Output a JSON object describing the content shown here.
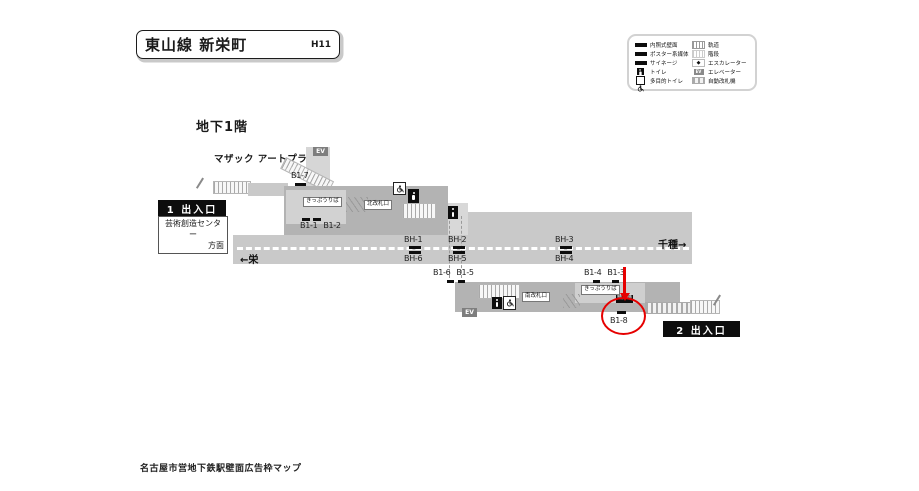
{
  "title": {
    "station_line": "東山線 新栄町",
    "station_code": "H11"
  },
  "floor_label": "地下1階",
  "note_mazak": "マザック アートプラザへ",
  "caption": "名古屋市営地下鉄駅壁面広告枠マップ",
  "legend": {
    "left": [
      {
        "icon": "lit-wall-sign",
        "label": "内照式壁面"
      },
      {
        "icon": "poster-media",
        "label": "ポスター系媒体"
      },
      {
        "icon": "signage",
        "label": "サイネージ"
      },
      {
        "icon": "toilet",
        "label": "トイレ"
      },
      {
        "icon": "accessible-toilet",
        "label": "多目的トイレ"
      }
    ],
    "right": [
      {
        "icon": "track",
        "label": "軌道"
      },
      {
        "icon": "stairs",
        "label": "階段"
      },
      {
        "icon": "escalator",
        "label": "エスカレーター"
      },
      {
        "icon": "elevator",
        "label": "エレベーター"
      },
      {
        "icon": "ticket-gate",
        "label": "自動改札機"
      }
    ]
  },
  "exit1": {
    "label": "1 出入口",
    "destination_line1": "芸術創造センター",
    "destination_line2": "方面"
  },
  "exit2": {
    "label": "2 出入口"
  },
  "directions": {
    "to_sakae": "←栄",
    "to_chikusa": "千種→"
  },
  "facilities": {
    "ticket_office_north": "きっぷうりば",
    "north_gate": "北改札口",
    "south_gate": "南改札口",
    "ticket_office_south": "きっぷうりば",
    "fare_adjustment": "精算機",
    "elevator": "EV",
    "escalator_mark": "◆"
  },
  "frames": {
    "b1_7": "B1-7",
    "b1_1": "B1-1",
    "b1_2": "B1-2",
    "bh_1": "BH-1",
    "bh_2": "BH-2",
    "bh_3": "BH-3",
    "bh_4": "BH-4",
    "bh_5": "BH-5",
    "bh_6": "BH-6",
    "b1_6": "B1-6",
    "b1_5": "B1-5",
    "b1_4": "B1-4",
    "b1_3": "B1-3",
    "b1_8": "B1-8"
  },
  "colors": {
    "highlight_red": "#e60000",
    "concourse_gray": "#b3b3b3",
    "platform_gray": "#c9c9c9",
    "frame_black": "#0d0d0d"
  }
}
